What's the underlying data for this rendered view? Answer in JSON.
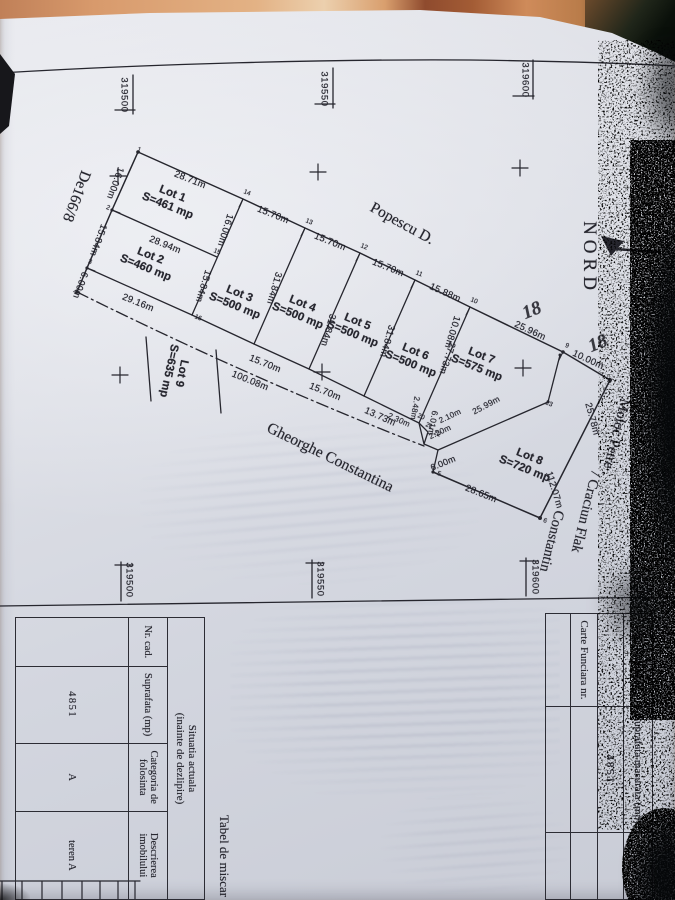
{
  "meta": {
    "kind": "scanned cadastral subdivision plan (photo, rotated 90deg)",
    "colors": {
      "paper": "#d9dbe3",
      "ink": "#26262e",
      "table_surface_orange": "#d69a6a",
      "background_dark": "#0d120c"
    }
  },
  "plan": {
    "labels": [
      {
        "t": "NORD",
        "x": 258,
        "y": 86,
        "r": 0,
        "c": "nord"
      },
      {
        "t": "319600",
        "x": 80,
        "y": 150,
        "r": 0,
        "c": "coord"
      },
      {
        "t": "319550",
        "x": 89,
        "y": 351,
        "r": 0,
        "c": "coord"
      },
      {
        "t": "319500",
        "x": 95,
        "y": 551,
        "r": 0,
        "c": "coord"
      },
      {
        "t": "319600",
        "x": 577,
        "y": 140,
        "r": 0,
        "c": "coord"
      },
      {
        "t": "319550",
        "x": 579,
        "y": 355,
        "r": 0,
        "c": "coord"
      },
      {
        "t": "319500",
        "x": 580,
        "y": 546,
        "r": 0,
        "c": "coord"
      },
      {
        "t": "De166/8",
        "x": 196,
        "y": 599,
        "r": 21,
        "c": "name"
      },
      {
        "t": "Popescu D.",
        "x": 224,
        "y": 273,
        "r": -61,
        "c": "name"
      },
      {
        "t": "Gheorghe Constantina",
        "x": 458,
        "y": 345,
        "r": -64,
        "c": "name"
      },
      {
        "t": "Moloc Petre .",
        "x": 437,
        "y": 60,
        "r": 14,
        "c": "name",
        "s": 14.5
      },
      {
        "t": "/ Craciun Flak",
        "x": 512,
        "y": 90,
        "r": 14,
        "c": "name",
        "s": 14.5
      },
      {
        "t": "Constantin",
        "x": 541,
        "y": 124,
        "r": 14,
        "c": "name",
        "s": 14.5
      },
      {
        "t": "18",
        "x": 311,
        "y": 143,
        "r": -112,
        "c": "hand"
      },
      {
        "t": "18",
        "x": 344,
        "y": 77,
        "r": -112,
        "c": "hand"
      },
      {
        "t": "28.71m",
        "x": 180,
        "y": 485,
        "r": -68,
        "c": "dim"
      },
      {
        "t": "15.70m",
        "x": 215,
        "y": 402,
        "r": -68,
        "c": "dim"
      },
      {
        "t": "15.70m",
        "x": 242,
        "y": 345,
        "r": -68,
        "c": "dim"
      },
      {
        "t": "15.70m",
        "x": 268,
        "y": 287,
        "r": -68,
        "c": "dim"
      },
      {
        "t": "15.88m",
        "x": 293,
        "y": 230,
        "r": -66,
        "c": "dim"
      },
      {
        "t": "25.96m",
        "x": 331,
        "y": 145,
        "r": -65,
        "c": "dim"
      },
      {
        "t": "10.00m",
        "x": 360,
        "y": 87,
        "r": -65,
        "c": "dim"
      },
      {
        "t": "28.94m",
        "x": 245,
        "y": 510,
        "r": -68,
        "c": "dim"
      },
      {
        "t": "29.16m",
        "x": 303,
        "y": 537,
        "r": -68,
        "c": "dim"
      },
      {
        "t": "15.70m",
        "x": 364,
        "y": 410,
        "r": -68,
        "c": "dim"
      },
      {
        "t": "15.70m",
        "x": 392,
        "y": 350,
        "r": -68,
        "c": "dim"
      },
      {
        "t": "13.73m",
        "x": 417,
        "y": 295,
        "r": -66,
        "c": "dim"
      },
      {
        "t": "2.30m",
        "x": 420,
        "y": 276,
        "r": -66,
        "c": "dim",
        "s": 8
      },
      {
        "t": "100.08m",
        "x": 381,
        "y": 425,
        "r": -68,
        "c": "dim"
      },
      {
        "t": "28.65m",
        "x": 494,
        "y": 194,
        "r": -68,
        "c": "dim"
      },
      {
        "t": "16.00m",
        "x": 183,
        "y": 560,
        "r": 20,
        "c": "dim"
      },
      {
        "t": "15.84m",
        "x": 240,
        "y": 577,
        "r": 20,
        "c": "dim"
      },
      {
        "t": "6.00m",
        "x": 285,
        "y": 595,
        "r": 20,
        "c": "dim"
      },
      {
        "t": "16.00m",
        "x": 230,
        "y": 450,
        "r": 17,
        "c": "dim"
      },
      {
        "t": "15.84m",
        "x": 286,
        "y": 472,
        "r": 17,
        "c": "dim"
      },
      {
        "t": "31.84m",
        "x": 288,
        "y": 401,
        "r": 16,
        "c": "dim"
      },
      {
        "t": "31.84m",
        "x": 330,
        "y": 347,
        "r": 16,
        "c": "dim"
      },
      {
        "t": "31.84m",
        "x": 341,
        "y": 288,
        "r": 16,
        "c": "dim"
      },
      {
        "t": "27.73m",
        "x": 358,
        "y": 228,
        "r": 18,
        "c": "dim"
      },
      {
        "t": "10.08m",
        "x": 332,
        "y": 223,
        "r": 17,
        "c": "dim"
      },
      {
        "t": "25.78m",
        "x": 419,
        "y": 83,
        "r": -15,
        "c": "dim"
      },
      {
        "t": "112.07m",
        "x": 490,
        "y": 121,
        "r": -17,
        "c": "dim"
      },
      {
        "t": "25.99m",
        "x": 405,
        "y": 189,
        "r": -118,
        "c": "dim",
        "s": 8.5
      },
      {
        "t": "2.10m",
        "x": 416,
        "y": 225,
        "r": -115,
        "c": "dim",
        "s": 8
      },
      {
        "t": "2.20m",
        "x": 432,
        "y": 235,
        "r": -115,
        "c": "dim",
        "s": 8
      },
      {
        "t": "6.00m",
        "x": 463,
        "y": 232,
        "r": -112,
        "c": "dim",
        "s": 9
      },
      {
        "t": "2.48m",
        "x": 408,
        "y": 260,
        "r": 10,
        "c": "dim",
        "s": 8
      },
      {
        "t": "6.01m",
        "x": 423,
        "y": 242,
        "r": 10,
        "c": "dim",
        "s": 8.5
      },
      {
        "t": "1",
        "x": 150,
        "y": 536,
        "r": -68,
        "c": "corner"
      },
      {
        "t": "2",
        "x": 208,
        "y": 567,
        "r": -68,
        "c": "corner"
      },
      {
        "t": "3",
        "x": 262,
        "y": 585,
        "r": -68,
        "c": "corner"
      },
      {
        "t": "4",
        "x": 292,
        "y": 600,
        "r": -68,
        "c": "corner"
      },
      {
        "t": "5",
        "x": 474,
        "y": 236,
        "r": -68,
        "c": "corner"
      },
      {
        "t": "6",
        "x": 521,
        "y": 130,
        "r": -68,
        "c": "corner"
      },
      {
        "t": "9",
        "x": 346,
        "y": 108,
        "r": -68,
        "c": "corner"
      },
      {
        "t": "10",
        "x": 301,
        "y": 201,
        "r": -68,
        "c": "corner"
      },
      {
        "t": "11",
        "x": 274,
        "y": 256,
        "r": -68,
        "c": "corner"
      },
      {
        "t": "12",
        "x": 247,
        "y": 311,
        "r": -68,
        "c": "corner"
      },
      {
        "t": "13",
        "x": 222,
        "y": 366,
        "r": -68,
        "c": "corner"
      },
      {
        "t": "14",
        "x": 193,
        "y": 428,
        "r": -68,
        "c": "corner"
      },
      {
        "t": "15",
        "x": 252,
        "y": 458,
        "r": -68,
        "c": "corner"
      },
      {
        "t": "16",
        "x": 318,
        "y": 477,
        "r": -68,
        "c": "corner"
      },
      {
        "t": "20",
        "x": 417,
        "y": 254,
        "r": -68,
        "c": "corner"
      },
      {
        "t": "21",
        "x": 426,
        "y": 246,
        "r": -68,
        "c": "corner"
      },
      {
        "t": "22",
        "x": 434,
        "y": 238,
        "r": -68,
        "c": "corner"
      },
      {
        "t": "23",
        "x": 404,
        "y": 126,
        "r": -68,
        "c": "corner"
      }
    ],
    "lots": [
      {
        "name": "Lot 1",
        "area": "S=461 mp",
        "x": 200,
        "y": 505,
        "r": -68
      },
      {
        "name": "Lot 2",
        "area": "S=460 mp",
        "x": 262,
        "y": 527,
        "r": -68
      },
      {
        "name": "Lot 3",
        "area": "S=500 mp",
        "x": 300,
        "y": 438,
        "r": -68
      },
      {
        "name": "Lot 4",
        "area": "S=500 mp",
        "x": 310,
        "y": 375,
        "r": -68
      },
      {
        "name": "Lot 5",
        "area": "S=500 mp",
        "x": 328,
        "y": 320,
        "r": -68
      },
      {
        "name": "Lot 6",
        "area": "S=500 mp",
        "x": 358,
        "y": 262,
        "r": -68
      },
      {
        "name": "Lot 7",
        "area": "S=575 mp",
        "x": 362,
        "y": 196,
        "r": -68
      },
      {
        "name": "Lot 8",
        "area": "S=720 mp",
        "x": 463,
        "y": 148,
        "r": -68
      },
      {
        "name": "Lot 9",
        "area": "S=635 mp",
        "x": 372,
        "y": 500,
        "r": 12
      }
    ]
  },
  "reg_table": {
    "r1c1": "Nr. cadastral",
    "r1c2": "Suprafata masurata (mp)",
    "r2c2": "4851",
    "r3c1": "Carte Funciara nr."
  },
  "mov_table": {
    "title": "Tabel de miscar",
    "band1": "Situatia actuala",
    "band2": "(inainte de dezlipire)",
    "col1": "Nr. cad.",
    "col2": "Suprafata (mp)",
    "col3": "Categoria de folosinta",
    "col4": "Descrierea imobilului",
    "val1": "",
    "val2": "4851",
    "val3": "A",
    "val4": "teren A"
  }
}
